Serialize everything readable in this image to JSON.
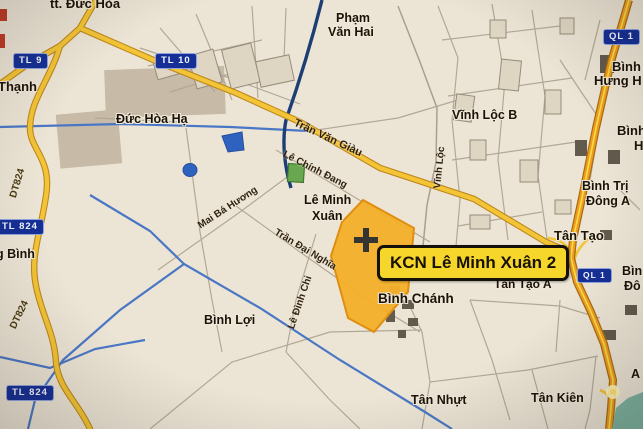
{
  "map": {
    "callout": {
      "label": "KCN Lê Minh Xuân 2"
    },
    "signs": {
      "tl9": "TL 9",
      "tl10": "TL 10",
      "ql1_top": "QL 1",
      "ql1_mid": "QL 1",
      "tl824_upper": "TL 824",
      "tl824_lower": "TL 824"
    },
    "streets": {
      "tran_van_giau": "Trần Văn Giàu",
      "le_chinh_dang": "Lê Chính Đang",
      "mai_ba_huong": "Mai Bá Hương",
      "vinh_loc": "Vĩnh Lộc",
      "tran_dai_nghia": "Trần Đại Nghĩa",
      "le_dinh_chi": "Lê Đình Chi",
      "dt824_upper": "DT824",
      "dt824_lower": "DT824"
    },
    "places": {
      "tt_duc_hoa": "tt. Đức Hòa",
      "thanh_partial": "Thạnh",
      "pham_van_hai_1": "Phạm",
      "pham_van_hai_2": "Văn Hai",
      "duc_hoa_ha": "Đức Hòa Hạ",
      "vinh_loc_b": "Vĩnh Lộc B",
      "binh_hung_hoa_1": "Bình",
      "binh_hung_hoa_2": "Hưng H",
      "binh_h_1": "Bình",
      "binh_h_2": "H",
      "binh_tri_dong_a_1": "Bình Trị",
      "binh_tri_dong_a_2": "Đông A",
      "le_minh_xuan_1": "Lê Minh",
      "le_minh_xuan_2": "Xuân",
      "tan_tao": "Tân Tạo",
      "tan_tao_a": "Tân Tạo A",
      "binh_chanh": "Bình Chánh",
      "binh_loi": "Bình Lợi",
      "g_binh_partial": "g Bình",
      "tan_nhut": "Tân Nhựt",
      "tan_kien": "Tân Kiên",
      "binh_partial_right_1": "Bìn",
      "binh_partial_right_2": "Đô",
      "a_partial": "A"
    },
    "colors": {
      "background": "#ece5d6",
      "road_yellow": "#f2c436",
      "highway_orange": "#ee9c1e",
      "canal_blue": "#4a77c5",
      "canal_navy": "#1d3e74",
      "sign_blue": "#152f96",
      "kcn_zone_yellow": "#f2b02a",
      "callout_yellow": "#f6d62a",
      "water_teal": "#7db4a2"
    }
  }
}
